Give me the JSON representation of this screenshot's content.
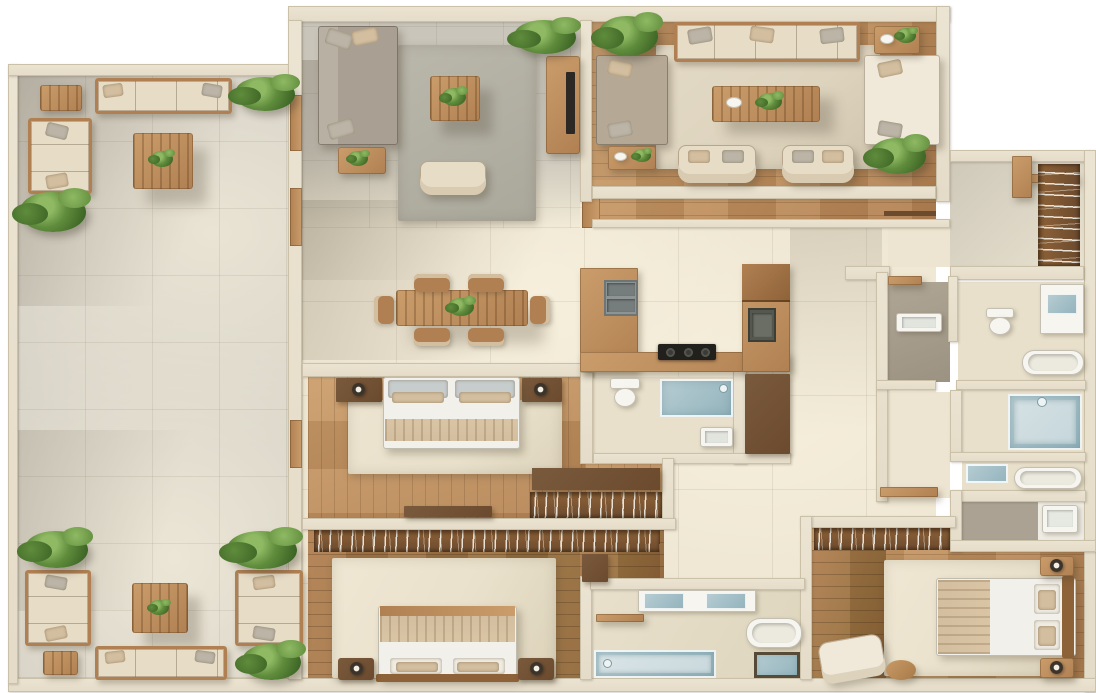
{
  "scene": {
    "description": "Top-down 3D rendered floor plan of a large furnished apartment with wrap-around balcony terrace",
    "background": "#ffffff",
    "visible_text": "none"
  },
  "palette": {
    "wall": "#ece4d2",
    "wall_edge": "#cbc0a8",
    "tile_cream": "#ede5d1",
    "tile_sun": "#f6efdc",
    "tile_shadow": "#cfc9bb",
    "balcony_gray": "#d6d2c8",
    "balcony_sun": "#eae4d4",
    "grid_line": "rgba(90,80,60,0.10)",
    "wood_light": "#cb9d6b",
    "wood_mid": "#b08052",
    "wood_dark": "#8e6238",
    "wood_deep": "#6b4a2e",
    "wood_floor_mid": "#bd8d5c",
    "wood_floor_dark": "#97703f",
    "rug_gray": "#bab7ab",
    "rug_beige": "#ddd3bd",
    "rug_cream": "#e9e1cb",
    "sofa_beige": "#e7dcc6",
    "sofa_cream": "#f0e9da",
    "sofa_gray": "#a9a093",
    "sofa_taupe": "#b5a996",
    "cushion_tan": "#d3bfa0",
    "pillow_gray": "#bcb5a7",
    "plant_light": "#8fb963",
    "plant_mid": "#5f8c3c",
    "plant_dark": "#3d6425",
    "glass_blue": "#b7cdd3",
    "glass_deep": "#93b3bc",
    "fixture_white": "#f7f5ef",
    "steel_gray": "#8d9494",
    "tile_bath": "#e8e0cb",
    "tile_bath_gray": "#aba293",
    "tv_black": "#2c2823",
    "cooktop_black": "#21201c",
    "lamp_dark": "#3c342a"
  },
  "inventory": {
    "rooms": [
      {
        "name": "balcony-terrace",
        "furniture": [
          "outdoor sofa x4",
          "corner loveseat",
          "coffee table x2",
          "side table x2",
          "potted plant x7"
        ]
      },
      {
        "name": "living-room",
        "furniture": [
          "gray sectional sofa",
          "coffee table with plant",
          "armchair",
          "side table",
          "tv console",
          "tv",
          "gray rug",
          "potted plant"
        ]
      },
      {
        "name": "dining-area",
        "furniture": [
          "wood dining table",
          "dining chair x6",
          "centerpiece plant"
        ]
      },
      {
        "name": "lounge",
        "furniture": [
          "sofa x3",
          "armchair x2",
          "coffee table with tray and plant",
          "side table x2",
          "beige rug",
          "potted plant x2"
        ]
      },
      {
        "name": "kitchen",
        "furniture": [
          "u-shaped wood counter",
          "double sink",
          "cooktop",
          "tall cabinet",
          "prep sink"
        ]
      },
      {
        "name": "guest-bathroom",
        "furniture": [
          "toilet",
          "glass shower",
          "washbasin",
          "tall wood cabinet"
        ]
      },
      {
        "name": "bedroom-1",
        "furniture": [
          "double bed",
          "headboard panel x2",
          "wall lamp x2",
          "cream rug",
          "dresser",
          "wardrobe with hangers"
        ]
      },
      {
        "name": "bedroom-2",
        "furniture": [
          "double bed",
          "nightstand x2",
          "table lamp x2",
          "cream rug",
          "wardrobe with hangers"
        ]
      },
      {
        "name": "master-bathroom",
        "furniture": [
          "double vanity",
          "bathtub",
          "walk-in shower",
          "basin",
          "wood shelf"
        ]
      },
      {
        "name": "bedroom-3",
        "furniture": [
          "double bed",
          "nightstand x2",
          "table lamp x2",
          "cream rug",
          "armchair",
          "ottoman",
          "wardrobe with hangers"
        ]
      },
      {
        "name": "ensuite-bathroom",
        "furniture": [
          "washbasin unit"
        ]
      },
      {
        "name": "walk-in-closet",
        "furniture": [
          "hanging wardrobe",
          "wood shelf"
        ]
      },
      {
        "name": "bathroom-2",
        "furniture": [
          "washbasin x2",
          "toilet",
          "bathtub",
          "vanity counter"
        ]
      },
      {
        "name": "shower-room",
        "furniture": [
          "walk-in glass shower"
        ]
      },
      {
        "name": "bathroom-3",
        "furniture": [
          "washbasin",
          "bathtub"
        ]
      },
      {
        "name": "hallway",
        "furniture": [
          "wood console"
        ]
      }
    ]
  }
}
